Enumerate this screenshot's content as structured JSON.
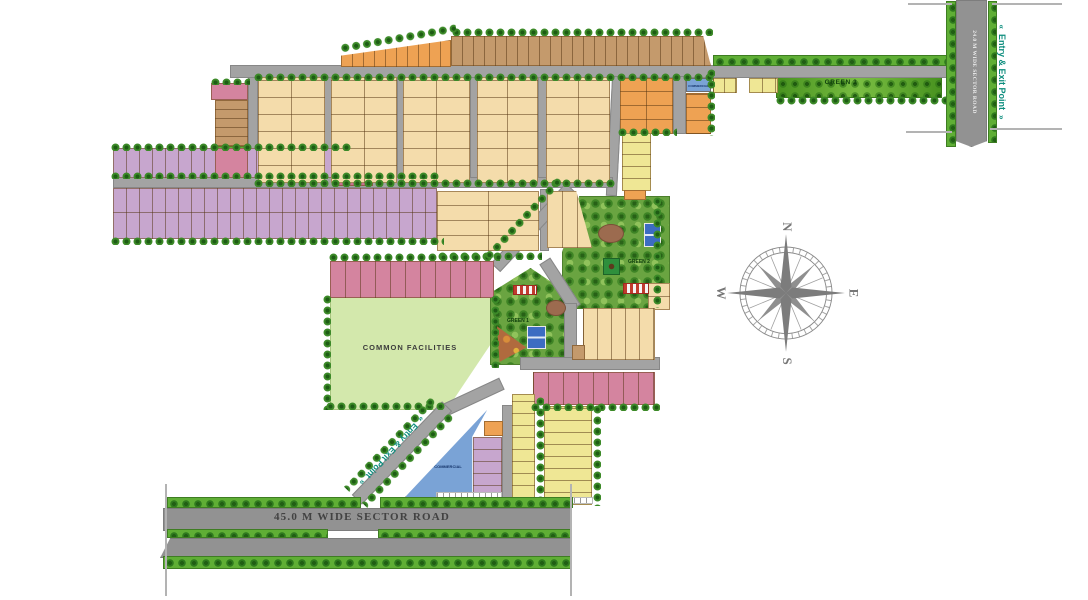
{
  "labels": {
    "entry_exit": "Entry & Exit Point",
    "chevron_left": "«",
    "chevron_right": "»",
    "road_24": "24.0 M WIDE SECTOR ROAD",
    "road_45": "45.0 M WIDE SECTOR ROAD",
    "green_1": "GREEN 1",
    "green_2": "GREEN 2",
    "green_3": "GREEN 3",
    "common_facilities": "COMMON FACILITIES",
    "commercial": "COMMERCIAL",
    "compass": {
      "n": "N",
      "e": "E",
      "s": "S",
      "w": "W"
    }
  },
  "colors": {
    "cream": "#f4dcab",
    "orange": "#eea253",
    "brown": "#c49a6c",
    "purple": "#c7a6ce",
    "pink": "#d4849f",
    "rose": "#c96e8e",
    "yellow": "#efe795",
    "blue": "#7aa3d6",
    "green_strip": "#5fae35",
    "teal_text": "#0d8d7e",
    "road_gray": "#a3a3a3",
    "park_green": "#6aa441",
    "common_facilities_green": "#d3e8ac",
    "court_blue": "#3c6cc2"
  },
  "map": {
    "shapes": [
      {
        "n": "common-facilities-area",
        "t": "cf",
        "x": 330,
        "y": 297,
        "w": 162,
        "h": 113,
        "clip": "polygon(0 0,100% 0,100% 40%,72% 100%,0 100%)"
      },
      {
        "n": "green-2-park",
        "t": "park",
        "x": 562,
        "y": 196,
        "w": 108,
        "h": 113,
        "clip": "polygon(16% 0,100% 0,100% 100%,0 100%,0 50%)"
      },
      {
        "n": "green-1-park",
        "t": "park",
        "x": 490,
        "y": 268,
        "w": 78,
        "h": 97,
        "clip": "polygon(0 26%,52% 0,100% 26%,100% 100%,0 100%)"
      },
      {
        "n": "green-3-strip",
        "t": "g3",
        "x": 776,
        "y": 77,
        "w": 166,
        "h": 21
      },
      {
        "n": "road-top",
        "t": "road",
        "x": 230,
        "y": 65,
        "w": 727,
        "h": 13
      },
      {
        "n": "road-col-left",
        "t": "road",
        "x": 248,
        "y": 77,
        "w": 10,
        "h": 106
      },
      {
        "n": "road-c1",
        "t": "road",
        "x": 324,
        "y": 77,
        "w": 8,
        "h": 106
      },
      {
        "n": "road-c2",
        "t": "road",
        "x": 397,
        "y": 77,
        "w": 7,
        "h": 106
      },
      {
        "n": "road-c3",
        "t": "road",
        "x": 470,
        "y": 77,
        "w": 8,
        "h": 106
      },
      {
        "n": "road-c4",
        "t": "road",
        "x": 538,
        "y": 77,
        "w": 9,
        "h": 106
      },
      {
        "n": "road-c5",
        "t": "road",
        "x": 609,
        "y": 76,
        "w": 11,
        "h": 120,
        "rot": 3
      },
      {
        "n": "road-mid-h",
        "t": "road",
        "x": 113,
        "y": 177,
        "w": 500,
        "h": 11
      },
      {
        "n": "road-b4b-right",
        "t": "road",
        "x": 540,
        "y": 189,
        "w": 9,
        "h": 62
      },
      {
        "n": "road-diagonal-a",
        "t": "road",
        "x": 478,
        "y": 221,
        "w": 110,
        "h": 13,
        "rot": 133
      },
      {
        "n": "road-branch-b",
        "t": "road",
        "x": 532,
        "y": 278,
        "w": 56,
        "h": 13,
        "rot": 57
      },
      {
        "n": "road-green1-right",
        "t": "road",
        "x": 564,
        "y": 303,
        "w": 13,
        "h": 60
      },
      {
        "n": "road-mid-south",
        "t": "road",
        "x": 520,
        "y": 357,
        "w": 140,
        "h": 13
      },
      {
        "n": "road-to-entry",
        "t": "road",
        "x": 439,
        "y": 391,
        "w": 66,
        "h": 13,
        "rot": 155
      },
      {
        "n": "road-entry-diagonal",
        "t": "road",
        "x": 337,
        "y": 446,
        "w": 130,
        "h": 14,
        "rot": 134
      },
      {
        "n": "road-commercial-right",
        "t": "road",
        "x": 502,
        "y": 405,
        "w": 12,
        "h": 93
      },
      {
        "n": "road-orange-right",
        "t": "road",
        "x": 673,
        "y": 76,
        "w": 13,
        "h": 58
      },
      {
        "n": "road-sector-24",
        "t": "road2",
        "x": 956,
        "y": 0,
        "w": 31,
        "h": 147,
        "clip": "polygon(0 0,100% 0,100% 96%,50% 100%,0 96%)"
      },
      {
        "n": "road-sector-45-north",
        "t": "road2",
        "x": 163,
        "y": 508,
        "w": 409,
        "h": 23
      },
      {
        "n": "road-sector-45-south",
        "t": "road2",
        "x": 160,
        "y": 538,
        "w": 412,
        "h": 20,
        "clip": "polygon(2.5% 0,100% 0,100% 100%,0 100%)"
      },
      {
        "n": "plot-left-pink-top",
        "t": "plot",
        "x": 211,
        "y": 83,
        "w": 37,
        "h": 17,
        "bg": "pink"
      },
      {
        "n": "plot-left-brown",
        "t": "plot",
        "x": 215,
        "y": 100,
        "w": 33,
        "h": 46,
        "bg": "brown",
        "sh": 9
      },
      {
        "n": "plot-left-green",
        "t": "plot",
        "x": 214,
        "y": 146,
        "w": 34,
        "h": 5,
        "bg": "green_strip"
      },
      {
        "n": "plot-purple-row1",
        "t": "plot",
        "x": 113,
        "y": 148,
        "w": 222,
        "h": 30,
        "bg": "purple",
        "sv": 13
      },
      {
        "n": "plot-pink-row1",
        "t": "plot",
        "x": 215,
        "y": 148,
        "w": 33,
        "h": 30,
        "bg": "pink"
      },
      {
        "n": "plot-rose-row1",
        "t": "plot",
        "x": 333,
        "y": 146,
        "w": 40,
        "h": 40,
        "bg": "rose",
        "sv": 13
      },
      {
        "n": "plot-purple-row2",
        "t": "plot",
        "x": 113,
        "y": 188,
        "w": 324,
        "h": 51,
        "bg": "purple",
        "sv": 13,
        "sh": 26
      },
      {
        "n": "plot-orange-steps",
        "t": "plot",
        "x": 341,
        "y": 40,
        "w": 110,
        "h": 27,
        "bg": "orange",
        "sv": 11,
        "clip": "polygon(0 100%,0 58%,100% 0,100% 100%)"
      },
      {
        "n": "plot-brown-top-row",
        "t": "plot",
        "x": 451,
        "y": 36,
        "w": 260,
        "h": 30,
        "bg": "brown",
        "sv": 11,
        "clip": "polygon(0 0,97% 0,100% 100%,0 100%)"
      },
      {
        "n": "plot-cream-b1",
        "t": "plot",
        "x": 258,
        "y": 77,
        "w": 67,
        "h": 106,
        "bg": "cream",
        "sv": 33,
        "sh": 17
      },
      {
        "n": "plot-cream-b2",
        "t": "plot",
        "x": 331,
        "y": 77,
        "w": 66,
        "h": 106,
        "bg": "cream",
        "sv": 33,
        "sh": 17
      },
      {
        "n": "plot-cream-b3",
        "t": "plot",
        "x": 403,
        "y": 77,
        "w": 67,
        "h": 106,
        "bg": "cream",
        "sv": 33,
        "sh": 17
      },
      {
        "n": "plot-cream-b4",
        "t": "plot",
        "x": 477,
        "y": 77,
        "w": 61,
        "h": 106,
        "bg": "cream",
        "sv": 30,
        "sh": 17
      },
      {
        "n": "plot-cream-b5",
        "t": "plot",
        "x": 546,
        "y": 77,
        "w": 64,
        "h": 106,
        "bg": "cream",
        "sv": 32,
        "sh": 17
      },
      {
        "n": "plot-cream-b4b",
        "t": "plot",
        "x": 437,
        "y": 191,
        "w": 102,
        "h": 60,
        "bg": "cream",
        "sv": 51,
        "sh": 15
      },
      {
        "n": "plot-cream-b5b",
        "t": "plot",
        "x": 547,
        "y": 191,
        "w": 45,
        "h": 57,
        "bg": "cream",
        "sv": 15,
        "clip": "polygon(0 0,65% 0,100% 100%,0 100%)"
      },
      {
        "n": "plot-orange-block",
        "t": "plot",
        "x": 620,
        "y": 78,
        "w": 53,
        "h": 56,
        "bg": "orange",
        "sv": 26,
        "sh": 14
      },
      {
        "n": "plot-commercial-small",
        "t": "plot",
        "x": 686,
        "y": 78,
        "w": 25,
        "h": 14,
        "bg": "blue"
      },
      {
        "n": "plot-orange-col",
        "t": "plot",
        "x": 686,
        "y": 93,
        "w": 25,
        "h": 41,
        "bg": "orange",
        "sh": 13
      },
      {
        "n": "plot-yellow-top-a",
        "t": "plot",
        "x": 713,
        "y": 78,
        "w": 24,
        "h": 15,
        "bg": "yellow",
        "sv": 11
      },
      {
        "n": "plot-yellow-top-b",
        "t": "plot",
        "x": 749,
        "y": 78,
        "w": 29,
        "h": 15,
        "bg": "yellow",
        "sv": 13
      },
      {
        "n": "plot-yellow-col",
        "t": "plot",
        "x": 622,
        "y": 133,
        "w": 29,
        "h": 58,
        "bg": "yellow",
        "sh": 12
      },
      {
        "n": "plot-orange-small",
        "t": "plot",
        "x": 624,
        "y": 190,
        "w": 22,
        "h": 10,
        "bg": "orange"
      },
      {
        "n": "plot-cream-right-small",
        "t": "plot",
        "x": 648,
        "y": 283,
        "w": 22,
        "h": 27,
        "bg": "cream",
        "sh": 13
      },
      {
        "n": "plot-cream-c",
        "t": "plot",
        "x": 583,
        "y": 308,
        "w": 72,
        "h": 52,
        "bg": "cream",
        "sv": 14
      },
      {
        "n": "plot-brown-small",
        "t": "plot",
        "x": 572,
        "y": 345,
        "w": 13,
        "h": 15,
        "bg": "brown"
      },
      {
        "n": "plot-pink-mid-row",
        "t": "plot",
        "x": 330,
        "y": 261,
        "w": 164,
        "h": 37,
        "bg": "pink",
        "sv": 15
      },
      {
        "n": "plot-pink-south-row",
        "t": "plot",
        "x": 533,
        "y": 372,
        "w": 122,
        "h": 33,
        "bg": "pink",
        "sv": 15
      },
      {
        "n": "plot-yellow-col-a",
        "t": "plot",
        "x": 512,
        "y": 394,
        "w": 23,
        "h": 104,
        "bg": "yellow",
        "sh": 12
      },
      {
        "n": "plot-yellow-block-b",
        "t": "plot",
        "x": 544,
        "y": 406,
        "w": 48,
        "h": 99,
        "bg": "yellow",
        "sh": 12
      },
      {
        "n": "plot-purple-col",
        "t": "plot",
        "x": 473,
        "y": 437,
        "w": 29,
        "h": 61,
        "bg": "purple",
        "sh": 12
      },
      {
        "n": "plot-orange-entry",
        "t": "plot",
        "x": 484,
        "y": 421,
        "w": 19,
        "h": 15,
        "bg": "orange"
      },
      {
        "n": "plot-commercial-triangle",
        "t": "plot",
        "x": 405,
        "y": 409,
        "w": 83,
        "h": 89,
        "bg": "blue",
        "clip": "polygon(99% 1%,81% 31%,81% 99%,0 99%)"
      },
      {
        "n": "tennis-court-green2",
        "t": "court",
        "x": 644,
        "y": 223,
        "w": 17,
        "h": 24
      },
      {
        "n": "kiosk-green2",
        "t": "kiosk",
        "x": 603,
        "y": 258,
        "w": 17,
        "h": 17
      },
      {
        "n": "playground-green2",
        "t": "ell",
        "x": 598,
        "y": 224,
        "w": 26,
        "h": 19
      },
      {
        "n": "shed-green2",
        "t": "rw",
        "x": 623,
        "y": 283,
        "w": 26,
        "h": 11
      },
      {
        "n": "tennis-court-green1",
        "t": "court",
        "x": 527,
        "y": 326,
        "w": 19,
        "h": 23
      },
      {
        "n": "shed-green1",
        "t": "rw",
        "x": 513,
        "y": 285,
        "w": 24,
        "h": 10
      },
      {
        "n": "playground-green1",
        "t": "tri",
        "x": 497,
        "y": 324,
        "w": 32,
        "h": 38,
        "clip": "polygon(0 6%,92% 62%,8% 100%)"
      },
      {
        "n": "pond-green1",
        "t": "ell",
        "x": 546,
        "y": 300,
        "w": 20,
        "h": 16
      },
      {
        "n": "sidewalk-a",
        "t": "wdash",
        "x": 436,
        "y": 492,
        "w": 66,
        "h": 7
      },
      {
        "n": "sidewalk-b",
        "t": "wdash",
        "x": 543,
        "y": 497,
        "w": 50,
        "h": 7
      },
      {
        "n": "tree-row",
        "t": "gdots",
        "x": 451,
        "y": 27,
        "w": 262,
        "h": 9
      },
      {
        "n": "tree-row",
        "t": "gdots",
        "x": 339,
        "y": 33,
        "w": 118,
        "h": 11,
        "rot": -10
      },
      {
        "n": "tree-row",
        "t": "gdots",
        "x": 253,
        "y": 72,
        "w": 462,
        "h": 9
      },
      {
        "n": "tree-row",
        "t": "gstrip",
        "x": 713,
        "y": 55,
        "w": 240,
        "h": 11
      },
      {
        "n": "tree-row",
        "t": "gdots",
        "x": 253,
        "y": 178,
        "w": 364,
        "h": 9
      },
      {
        "n": "tree-row",
        "t": "gdots",
        "x": 110,
        "y": 142,
        "w": 242,
        "h": 9
      },
      {
        "n": "tree-row",
        "t": "gdots",
        "x": 110,
        "y": 171,
        "w": 330,
        "h": 8
      },
      {
        "n": "tree-row",
        "t": "gdots",
        "x": 110,
        "y": 236,
        "w": 334,
        "h": 9
      },
      {
        "n": "tree-row",
        "t": "gdots",
        "x": 437,
        "y": 251,
        "w": 105,
        "h": 9
      },
      {
        "n": "tree-row",
        "t": "gdots",
        "x": 328,
        "y": 252,
        "w": 172,
        "h": 9
      },
      {
        "n": "tree-row",
        "t": "gdots",
        "x": 322,
        "y": 294,
        "w": 9,
        "h": 116
      },
      {
        "n": "tree-row",
        "t": "gdots",
        "x": 325,
        "y": 401,
        "w": 122,
        "h": 9
      },
      {
        "n": "tree-row",
        "t": "gdots",
        "x": 490,
        "y": 294,
        "w": 9,
        "h": 74
      },
      {
        "n": "tree-row",
        "t": "gdots",
        "x": 775,
        "y": 95,
        "w": 172,
        "h": 10
      },
      {
        "n": "tree-row",
        "t": "gstrip",
        "x": 946,
        "y": 1,
        "w": 10,
        "h": 146
      },
      {
        "n": "tree-row",
        "t": "gstrip",
        "x": 988,
        "y": 1,
        "w": 9,
        "h": 142
      },
      {
        "n": "tree-row",
        "t": "gdots",
        "x": 706,
        "y": 68,
        "w": 9,
        "h": 68
      },
      {
        "n": "tree-row",
        "t": "gdots",
        "x": 652,
        "y": 196,
        "w": 9,
        "h": 112
      },
      {
        "n": "tree-row",
        "t": "gdots",
        "x": 617,
        "y": 127,
        "w": 60,
        "h": 9
      },
      {
        "n": "tree-row",
        "t": "gdots",
        "x": 530,
        "y": 402,
        "w": 130,
        "h": 9
      },
      {
        "n": "tree-row",
        "t": "gdots",
        "x": 535,
        "y": 396,
        "w": 9,
        "h": 106
      },
      {
        "n": "tree-row",
        "t": "gdots",
        "x": 592,
        "y": 404,
        "w": 9,
        "h": 102
      },
      {
        "n": "tree-row",
        "t": "gstrip",
        "x": 167,
        "y": 497,
        "w": 194,
        "h": 11
      },
      {
        "n": "tree-row",
        "t": "gstrip",
        "x": 380,
        "y": 497,
        "w": 193,
        "h": 11
      },
      {
        "n": "tree-row",
        "t": "gstrip",
        "x": 167,
        "y": 529,
        "w": 161,
        "h": 9
      },
      {
        "n": "tree-row",
        "t": "gstrip",
        "x": 378,
        "y": 529,
        "w": 193,
        "h": 9
      },
      {
        "n": "tree-row",
        "t": "gstrip",
        "x": 163,
        "y": 556,
        "w": 409,
        "h": 13
      },
      {
        "n": "tree-row",
        "t": "gdots",
        "x": 328,
        "y": 440,
        "w": 126,
        "h": 9,
        "rot": 134
      },
      {
        "n": "tree-row",
        "t": "gdots",
        "x": 346,
        "y": 456,
        "w": 126,
        "h": 9,
        "rot": 134
      },
      {
        "n": "tree-row",
        "t": "gdots",
        "x": 469,
        "y": 215,
        "w": 110,
        "h": 9,
        "rot": 133
      },
      {
        "n": "tree-row",
        "t": "gdots",
        "x": 210,
        "y": 77,
        "w": 40,
        "h": 8
      },
      {
        "n": "road-edge-tick",
        "t": "tick",
        "x": 165,
        "y": 484,
        "w": 2,
        "h": 112
      },
      {
        "n": "road-edge-tick",
        "t": "tick",
        "x": 570,
        "y": 484,
        "w": 2,
        "h": 112
      },
      {
        "n": "road-edge-tick",
        "t": "tick",
        "x": 906,
        "y": 131,
        "w": 46,
        "h": 2
      },
      {
        "n": "road-edge-tick",
        "t": "tick",
        "x": 990,
        "y": 128,
        "w": 72,
        "h": 2
      },
      {
        "n": "road-edge-tick",
        "t": "tick",
        "x": 908,
        "y": 3,
        "w": 44,
        "h": 2
      },
      {
        "n": "road-edge-tick",
        "t": "tick",
        "x": 992,
        "y": 3,
        "w": 70,
        "h": 2
      }
    ]
  }
}
